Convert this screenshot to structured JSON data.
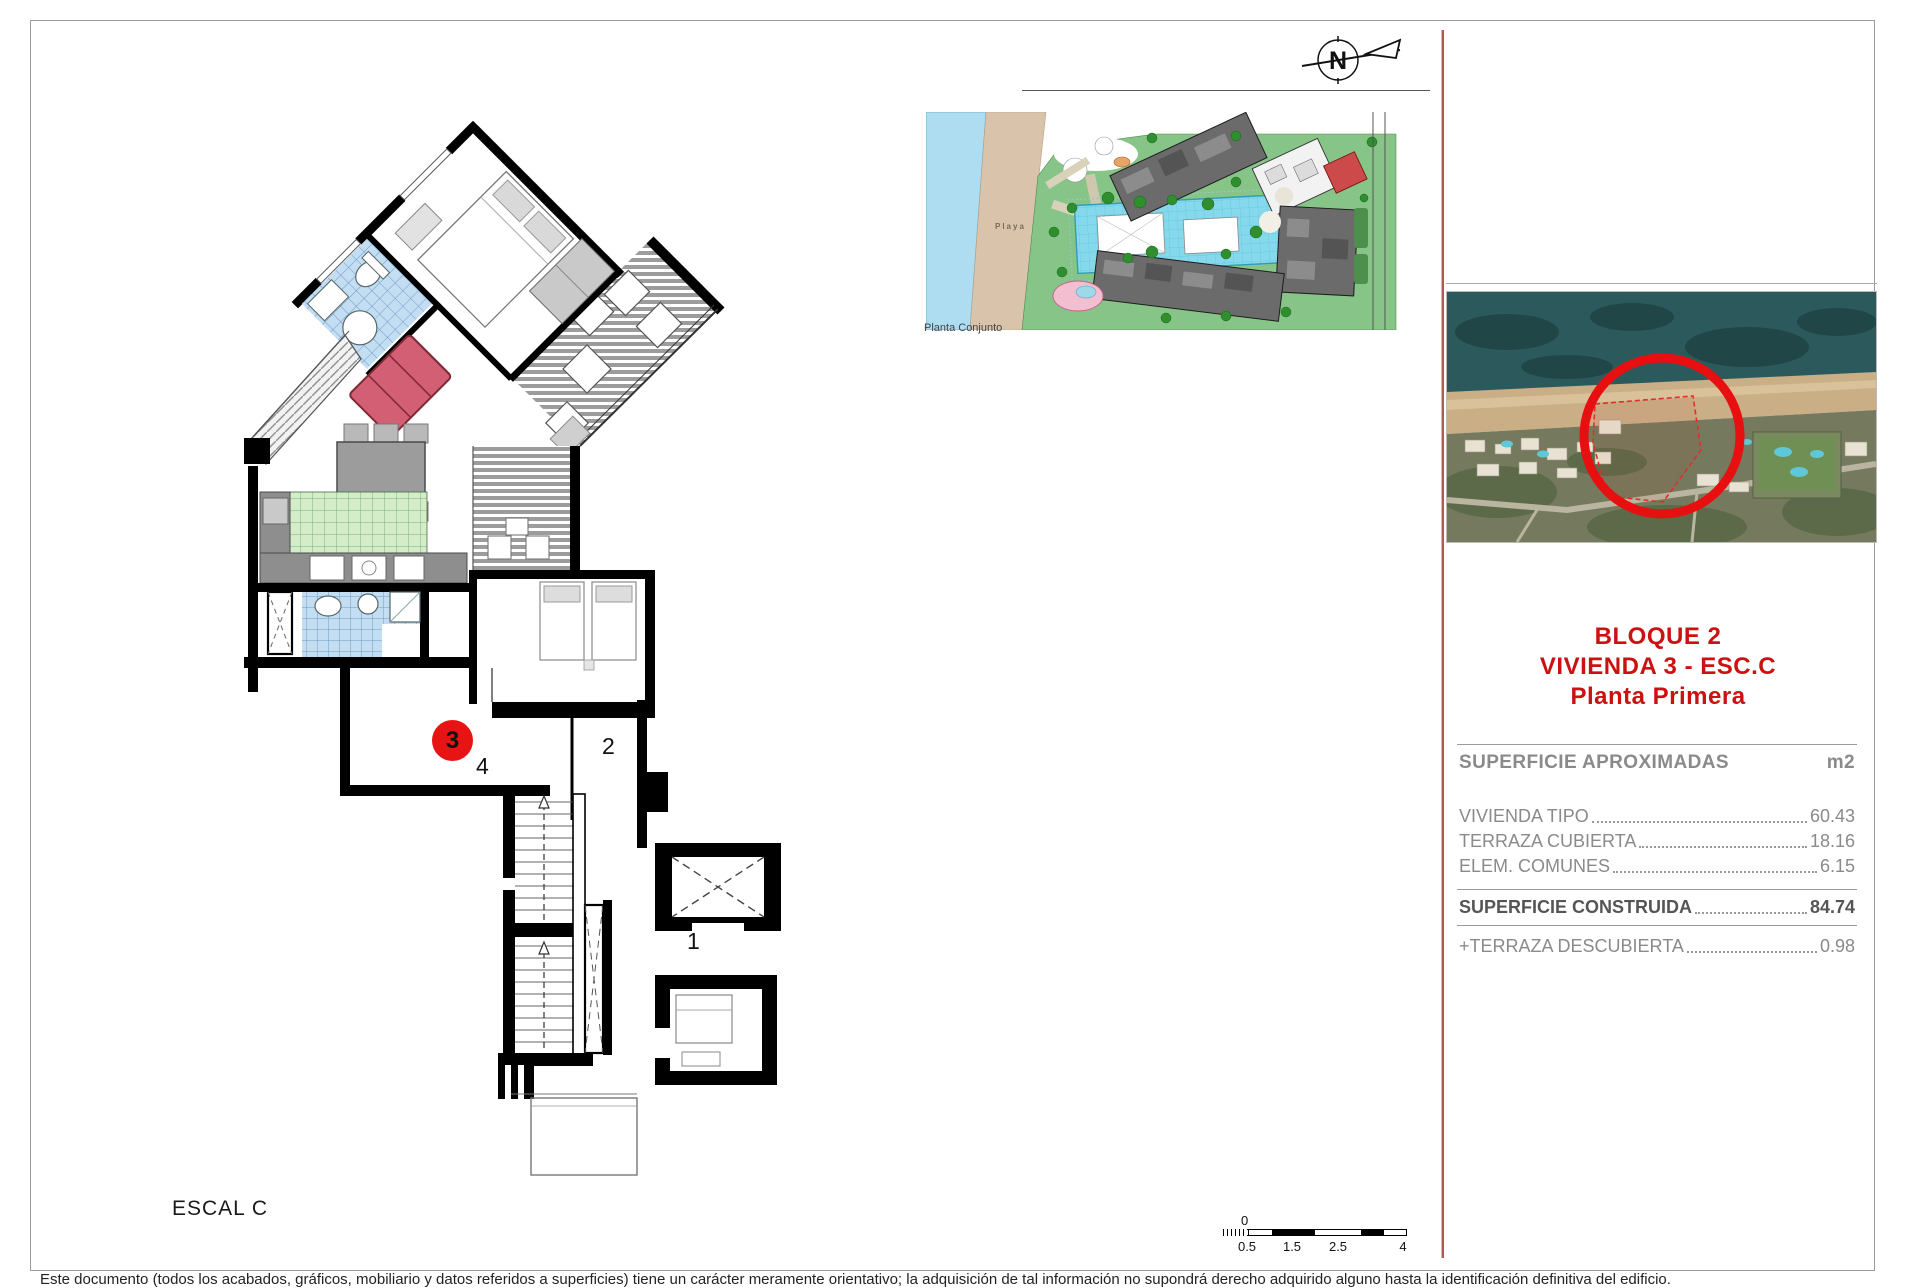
{
  "sheet": {
    "escalera_label": "ESCAL C",
    "site_plan_label": "Planta Conjunto",
    "playa_label": "Playa",
    "north_label": "N"
  },
  "plan": {
    "units": {
      "u1": "1",
      "u2": "2",
      "u3": "3",
      "u4": "4"
    },
    "highlight_color": "#e81414"
  },
  "panel": {
    "title_lines": [
      "BLOQUE 2",
      "VIVIENDA 3 - ESC.C",
      "Planta Primera"
    ],
    "title_color": "#cc1111",
    "table": {
      "header": "SUPERFICIE APROXIMADAS",
      "unit": "m2",
      "rows": [
        {
          "label": "VIVIENDA TIPO",
          "value": "60.43"
        },
        {
          "label": "TERRAZA CUBIERTA",
          "value": "18.16"
        },
        {
          "label": "ELEM. COMUNES",
          "value": "6.15"
        }
      ],
      "total": {
        "label": "SUPERFICIE CONSTRUIDA",
        "value": "84.74"
      },
      "extra": {
        "label": "+TERRAZA DESCUBIERTA",
        "value": "0.98"
      }
    }
  },
  "scalebar": {
    "zero": "0",
    "labels": [
      "0.5",
      "1.5",
      "2.5",
      "4"
    ]
  },
  "footer": {
    "disclaimer": "Este documento (todos los acabados, gráficos, mobiliario y datos referidos a superficies) tiene un carácter meramente orientativo; la adquisición de tal información no supondrá derecho adquirido alguno hasta la identificación definitiva del edificio."
  }
}
